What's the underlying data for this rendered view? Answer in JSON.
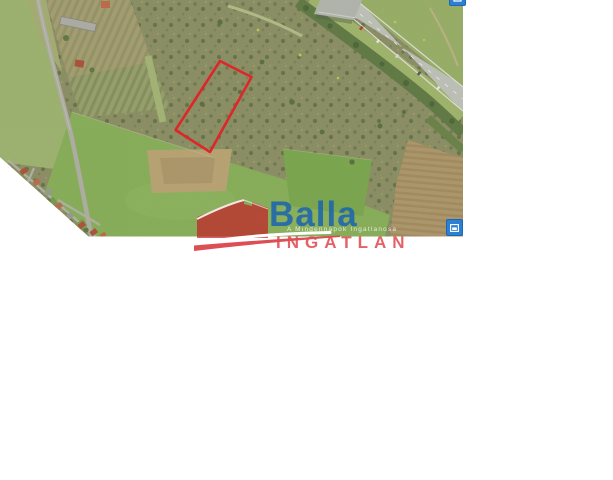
{
  "watermark": {
    "brand": "Balla",
    "tagline": "A Mindennapok Ingatlanosa",
    "wordmark": "INGATLAN",
    "brand_color": "#1d65ad",
    "wordmark_color": "#e24b52",
    "house_color": "#c32128"
  },
  "map": {
    "plot_outline_color": "#ee1c24",
    "plot_marker": "red-parcel-outline"
  },
  "controls": {
    "button_color": "#2d7fd2",
    "top_button_icon": "map-control-icon",
    "bottom_button_icon": "expand-icon"
  }
}
